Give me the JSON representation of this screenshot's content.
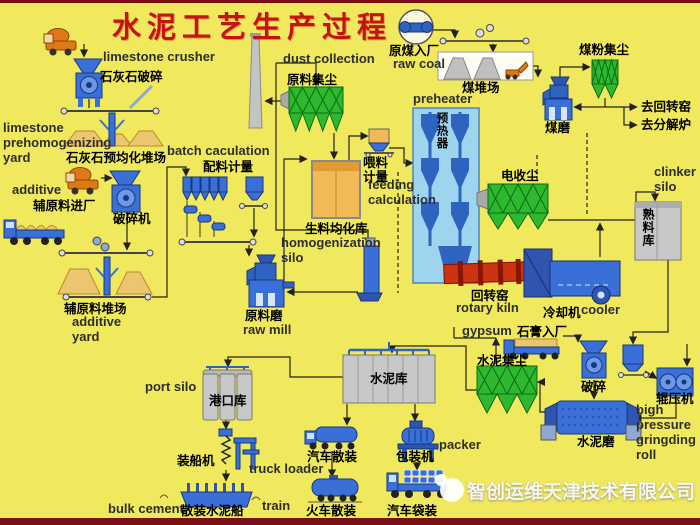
{
  "title": "水泥工艺生产过程",
  "watermark": {
    "company": "智创运维天津技术有限公司"
  },
  "colors": {
    "background": "#f0e95e",
    "frame_border": "#7a1014",
    "machine_blue": "#3a6fd8",
    "machine_blue_dark": "#2f55b0",
    "collector_green": "#2db82d",
    "kiln_red": "#cc3311",
    "material_tan": "#f2b957",
    "pile_tan": "#ecc66e",
    "silo_gray": "#c8c8c8",
    "title_red": "#c41313"
  },
  "labels": [
    {
      "id": "limestone-crusher-en",
      "t": "limestone crusher",
      "x": 103,
      "y": 50,
      "c": "en"
    },
    {
      "id": "limestone-crusher-zh",
      "t": "石灰石破碎",
      "x": 100,
      "y": 70,
      "c": "zh"
    },
    {
      "id": "limestone-yard-en",
      "t": "limestone\nprehomogenizing\nyard",
      "x": 3,
      "y": 121,
      "c": "en"
    },
    {
      "id": "limestone-yard-zh",
      "t": "石灰石预均化堆场",
      "x": 66,
      "y": 151,
      "c": "zh"
    },
    {
      "id": "batch-calculation-en",
      "t": "batch caculation",
      "x": 167,
      "y": 144,
      "c": "en"
    },
    {
      "id": "batch-calculation-zh",
      "t": "配料计量",
      "x": 203,
      "y": 160,
      "c": "zh"
    },
    {
      "id": "additive-en",
      "t": "additive",
      "x": 12,
      "y": 183,
      "c": "en"
    },
    {
      "id": "additive-zh",
      "t": "辅原料进厂",
      "x": 33,
      "y": 199,
      "c": "zh"
    },
    {
      "id": "crusher-zh",
      "t": "破碎机",
      "x": 113,
      "y": 212,
      "c": "zh"
    },
    {
      "id": "additive-yard-zh",
      "t": "辅原料堆场",
      "x": 64,
      "y": 302,
      "c": "zh"
    },
    {
      "id": "additive-yard-en",
      "t": "additive\nyard",
      "x": 72,
      "y": 315,
      "c": "en"
    },
    {
      "id": "raw-mill-zh",
      "t": "原料磨",
      "x": 245,
      "y": 309,
      "c": "zh"
    },
    {
      "id": "raw-mill-en",
      "t": "raw mill",
      "x": 243,
      "y": 323,
      "c": "en"
    },
    {
      "id": "dust-collection-en",
      "t": "dust collection",
      "x": 283,
      "y": 52,
      "c": "en"
    },
    {
      "id": "raw-dust-zh",
      "t": "原料集尘",
      "x": 287,
      "y": 73,
      "c": "zh"
    },
    {
      "id": "homogenization-zh",
      "t": "生料均化库",
      "x": 305,
      "y": 222,
      "c": "zh"
    },
    {
      "id": "homogenization-en",
      "t": "homogenization\nsilo",
      "x": 281,
      "y": 236,
      "c": "en"
    },
    {
      "id": "feeding-calc-zh",
      "t": "喂料\n计量",
      "x": 363,
      "y": 156,
      "c": "zh"
    },
    {
      "id": "feeding-calc-en",
      "t": "feeding\ncalculation",
      "x": 368,
      "y": 178,
      "c": "en"
    },
    {
      "id": "preheater-en",
      "t": "preheater",
      "x": 413,
      "y": 92,
      "c": "en"
    },
    {
      "id": "preheater-zh",
      "t": "预热器",
      "x": 436,
      "y": 112,
      "c": "zh-v",
      "fs": 11.5
    },
    {
      "id": "raw-coal-zh",
      "t": "原煤入厂",
      "x": 389,
      "y": 44,
      "c": "zh"
    },
    {
      "id": "raw-coal-en",
      "t": "raw coal",
      "x": 393,
      "y": 57,
      "c": "en"
    },
    {
      "id": "coal-yard-zh",
      "t": "煤堆场",
      "x": 462,
      "y": 81,
      "c": "zh"
    },
    {
      "id": "coal-dust-zh",
      "t": "煤粉集尘",
      "x": 579,
      "y": 43,
      "c": "zh"
    },
    {
      "id": "coal-mill-zh",
      "t": "煤磨",
      "x": 545,
      "y": 121,
      "c": "zh"
    },
    {
      "id": "to-rotary-kiln-zh",
      "t": "去回转窑",
      "x": 641,
      "y": 100,
      "c": "zh"
    },
    {
      "id": "to-calciner-zh",
      "t": "去分解炉",
      "x": 641,
      "y": 118,
      "c": "zh"
    },
    {
      "id": "electro-precipitator-zh",
      "t": "电收尘",
      "x": 501,
      "y": 169,
      "c": "zh"
    },
    {
      "id": "clinker-silo-en",
      "t": "clinker\nsilo",
      "x": 654,
      "y": 165,
      "c": "en"
    },
    {
      "id": "clinker-silo-zh",
      "t": "熟料库",
      "x": 642,
      "y": 208,
      "c": "zh-v",
      "fs": 12
    },
    {
      "id": "rotary-kiln-zh",
      "t": "回转窑",
      "x": 471,
      "y": 289,
      "c": "zh"
    },
    {
      "id": "rotary-kiln-en",
      "t": "rotary kiln",
      "x": 456,
      "y": 301,
      "c": "en"
    },
    {
      "id": "cooler-zh",
      "t": "冷却机",
      "x": 543,
      "y": 306,
      "c": "zh"
    },
    {
      "id": "cooler-en",
      "t": "cooler",
      "x": 581,
      "y": 303,
      "c": "en"
    },
    {
      "id": "gypsum-en",
      "t": "gypsum",
      "x": 462,
      "y": 324,
      "c": "en"
    },
    {
      "id": "gypsum-zh",
      "t": "石膏入厂",
      "x": 517,
      "y": 325,
      "c": "zh"
    },
    {
      "id": "cement-dust-zh",
      "t": "水泥集尘",
      "x": 477,
      "y": 354,
      "c": "zh"
    },
    {
      "id": "gypsum-crusher-zh",
      "t": "破碎",
      "x": 581,
      "y": 380,
      "c": "zh"
    },
    {
      "id": "roller-press-zh",
      "t": "辊压机",
      "x": 656,
      "y": 392,
      "c": "zh"
    },
    {
      "id": "roller-press-en",
      "t": "bigh\npressure\ngringding\nroll",
      "x": 636,
      "y": 403,
      "c": "en"
    },
    {
      "id": "cement-mill-zh",
      "t": "水泥磨",
      "x": 577,
      "y": 435,
      "c": "zh"
    },
    {
      "id": "cement-silo-zh",
      "t": "水泥库",
      "x": 370,
      "y": 372,
      "c": "zh"
    },
    {
      "id": "port-silo-en",
      "t": "port silo",
      "x": 145,
      "y": 380,
      "c": "en"
    },
    {
      "id": "port-silo-zh",
      "t": "港口库",
      "x": 209,
      "y": 394,
      "c": "zh"
    },
    {
      "id": "ship-loader-zh",
      "t": "装船机",
      "x": 177,
      "y": 454,
      "c": "zh"
    },
    {
      "id": "truck-loader-en",
      "t": "truck loader",
      "x": 249,
      "y": 462,
      "c": "en"
    },
    {
      "id": "bulk-cement-en",
      "t": "bulk cement",
      "x": 108,
      "y": 502,
      "c": "en"
    },
    {
      "id": "bulk-ship-zh",
      "t": "散装水泥船",
      "x": 181,
      "y": 504,
      "c": "zh"
    },
    {
      "id": "train-en",
      "t": "train",
      "x": 262,
      "y": 499,
      "c": "en"
    },
    {
      "id": "truck-bulk-zh",
      "t": "汽车散装",
      "x": 307,
      "y": 450,
      "c": "zh"
    },
    {
      "id": "train-bulk-zh",
      "t": "火车散装",
      "x": 306,
      "y": 504,
      "c": "zh"
    },
    {
      "id": "packer-zh",
      "t": "包装机",
      "x": 396,
      "y": 450,
      "c": "zh"
    },
    {
      "id": "packer-en",
      "t": "packer",
      "x": 439,
      "y": 438,
      "c": "en"
    },
    {
      "id": "truck-bag-zh",
      "t": "汽车袋装",
      "x": 387,
      "y": 504,
      "c": "zh"
    }
  ]
}
